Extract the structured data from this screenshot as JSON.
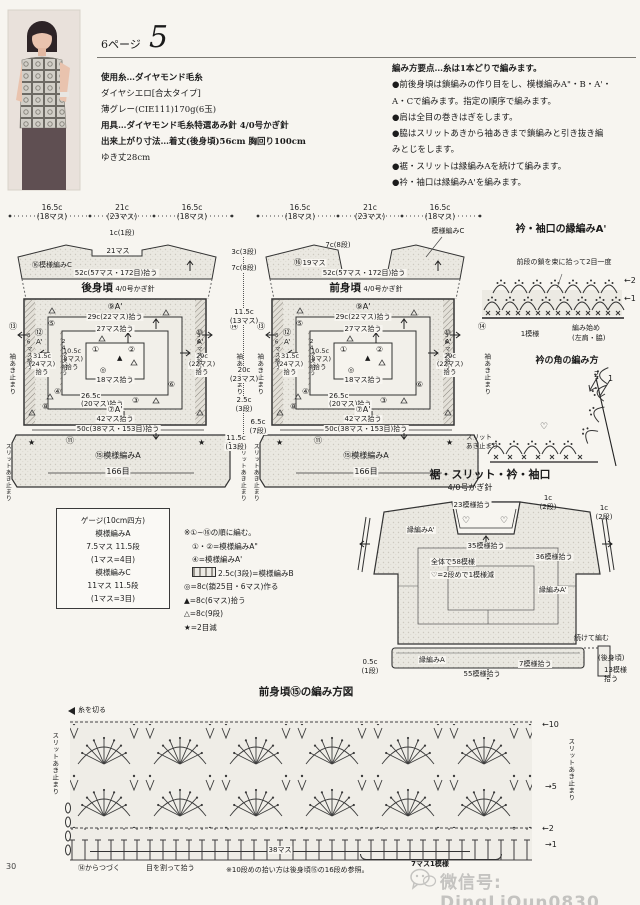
{
  "header": {
    "page_label": "6ページ",
    "num": "5"
  },
  "materials": {
    "l0": "使用糸…ダイヤモンド毛糸",
    "l1": "ダイヤシエロ[合太タイプ]",
    "l2": "薄グレー(CIE111)170g(6玉)",
    "l3": "用具…ダイヤモンド毛糸特選あみ針 4/0号かぎ針",
    "l4": "出来上がり寸法…着丈(後身頃)56cm 胸回り100cm",
    "l5": "ゆき丈28cm"
  },
  "points": {
    "l0": "編み方要点…糸は1本どりで編みます。",
    "l1": "●前後身頃は鎖編みの作り目をし、模様編みA\"・B・A'・",
    "l2": "A・Cで編みます。指定の順序で編みます。",
    "l3": "●肩は全目の巻きはぎをします。",
    "l4": "●脇はスリットあきから袖あきまで鎖編みと引き抜き編",
    "l5": "みとじをします。",
    "l6": "●裾・スリットは縁編みAを続けて編みます。",
    "l7": "●衿・袖口は縁編みA'を編みます。"
  },
  "sch": {
    "dim_l": "16.5c",
    "dim_l2": "(18マス)",
    "dim_c": "21c",
    "dim_c2": "(23マス)",
    "dim_r": "16.5c",
    "dim_r2": "(18マス)",
    "pickup52": "52c(57マス・172目)拾う",
    "hook": "4/0号かぎ針",
    "a9": "⑨A'",
    "pick29t": "29c(22マス)拾う",
    "pick27": "27マス拾う",
    "n1": "①",
    "n2": "②",
    "n3": "③",
    "n4": "④",
    "n5": "⑤",
    "n6": "⑥",
    "n8": "⑧",
    "n11": "⑪",
    "n13": "⑬",
    "n14": "⑭",
    "n12": "⑫",
    "n10": "⑩",
    "aq": "A'",
    "tri_f": "▲",
    "ring": "◎",
    "star": "★",
    "pick18": "18マス拾う",
    "c105": "10.5c",
    "c105b": "(8マス)",
    "pick": "拾う",
    "c265": "26.5c",
    "c265b": "(20マス)拾う",
    "a7": "⑦A'",
    "pick42": "42マス拾う",
    "c315": "31.5c",
    "c315b": "(24マス)",
    "c29": "29c",
    "c29b": "(22マス)",
    "v24": "24マス拾う",
    "v36": "36マス拾う",
    "sleeve_stop": "袖あき止まり",
    "pick50": "50c(38マス・153目)拾う",
    "band": "⑮模様編みA",
    "sts": "166目",
    "slit_stop": "スリットあき止まり"
  },
  "back": {
    "title": "後身頃",
    "neck_h": "1c(1段)",
    "neck_sts": "21マス",
    "yoke": "⑯模様編みC"
  },
  "front": {
    "title": "前身頃",
    "neck_h": "7c(8段)",
    "neck_sts": "19マス",
    "yoke": "模様編みC",
    "yoke_n": "⑯",
    "slit1": "スリット",
    "slit2": "あき止まり"
  },
  "cdims": {
    "d1": "3c(3段)",
    "d2": "7c(8段)",
    "d3": "11.5c",
    "d3b": "(13マス)",
    "d4": "20c",
    "d4b": "(23マス)",
    "d5": "2.5c",
    "d5b": "(3段)",
    "d6": "6.5c",
    "d6b": "(7段)",
    "d7": "11.5c",
    "d7b": "(13段)"
  },
  "collar": {
    "title": "衿・袖口の縁編みA'",
    "note": "前段の鎖を束に拾って2目一度",
    "r2": "←2",
    "r1": "←1",
    "motif": "1模様",
    "start1": "編み始め",
    "start2": "(左肩・脇)",
    "corner_title": "衿の角の編み方",
    "n2": "2",
    "n1": "1",
    "heart": "♡"
  },
  "hem": {
    "title": "裾・スリット・衿・袖口",
    "hook": "4/0号かぎ針",
    "pick23": "23模様拾う",
    "c1a": "1c",
    "c1b": "(2段)",
    "edgeA2": "縁編みA'",
    "pick35": "35模様拾う",
    "total": "全体で58模様",
    "dec": "♡=2段めで1模様減",
    "pick36": "36模様拾う",
    "edgeA2r": "縁編みA'",
    "cont": "続けて編む",
    "back_ref": "(後身頃)",
    "c05": "0.5c",
    "c05b": "(1段)",
    "edgeA": "縁編みA",
    "pick55": "55模様拾う",
    "pick7": "7模様拾う",
    "pick13a": "13模様",
    "pick13b": "拾う",
    "heart": "♡"
  },
  "gauge": {
    "l0": "ゲージ(10cm四方)",
    "l1": "模様編みA",
    "l2": "7.5マス 11.5段",
    "l3": "(1マス=4目)",
    "l4": "模様編みC",
    "l5": "11マス 11.5段",
    "l6": "(1マス=3目)"
  },
  "legend": {
    "l0": "※①~⑯の順に編む。",
    "l1": "①・②=模様編みA\"",
    "l2": "④=模様編みA'",
    "l3": "2.5c(3段)=模様編みB",
    "l4": "◎=8c(鎖25目・6マス)作る",
    "l5": "▲=8c(6マス)拾う",
    "l6": "△=8c(9段)",
    "l7": "★=2目減"
  },
  "chart": {
    "title": "前身頃⑮の編み方図",
    "cut": "糸を切る",
    "slit": "スリットあき止まり",
    "r10": "←10",
    "r5": "→5",
    "r2": "←2",
    "r1": "→1",
    "cont": "⑭からつづく",
    "split": "目を割って拾う",
    "w": "38マス",
    "motif": "7マス1模様",
    "note": "※10段めの拾い方は後身頃⑮の16段め参照。"
  },
  "footer": {
    "page_num": "30",
    "watermark": "微信号: DingLiQun0830"
  }
}
